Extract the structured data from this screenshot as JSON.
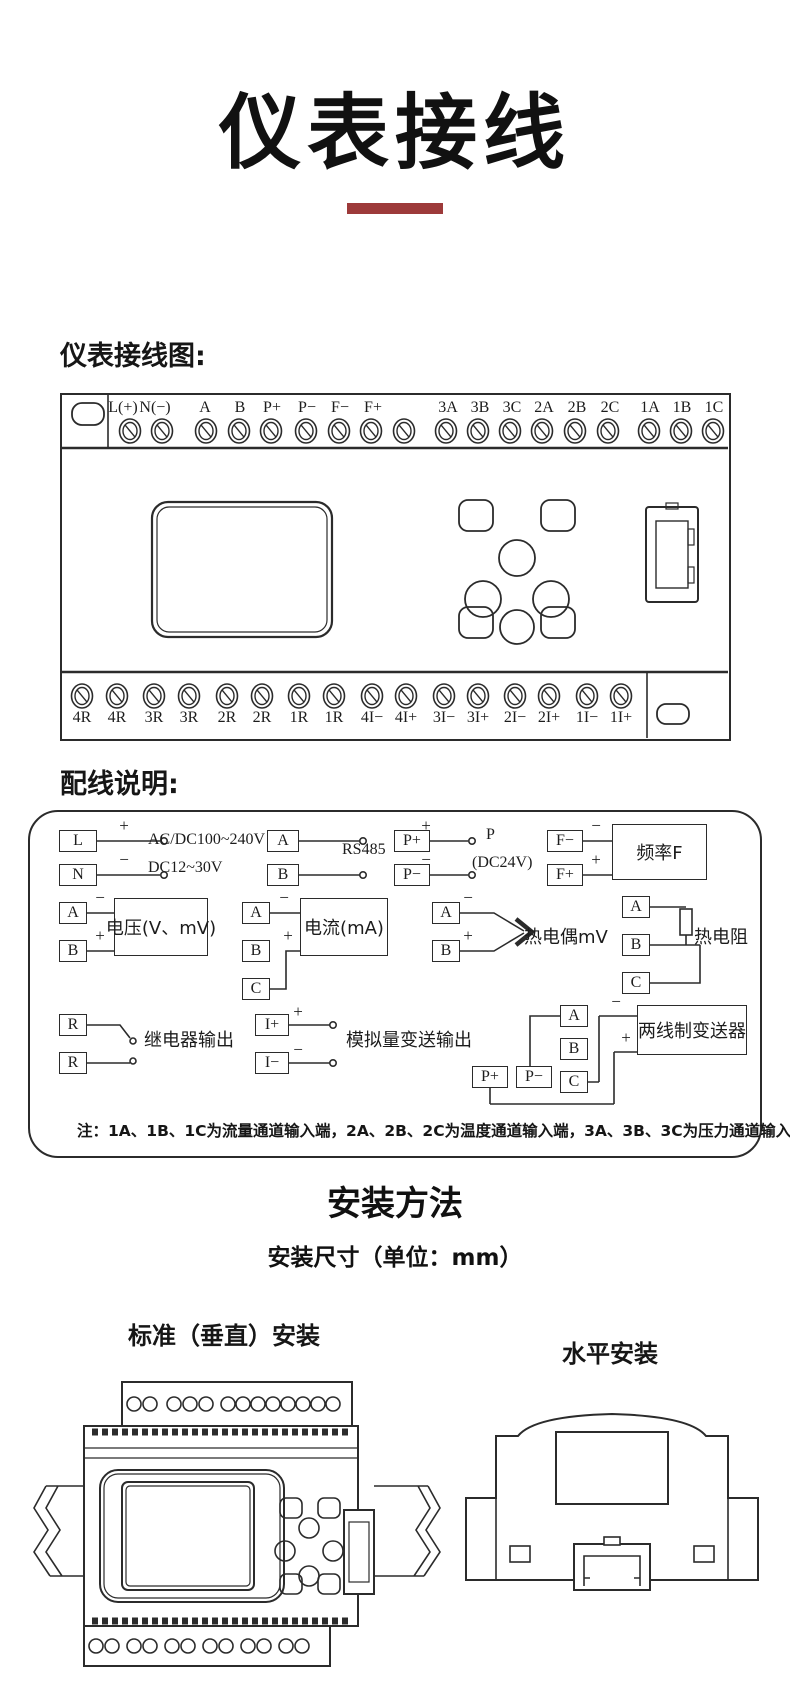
{
  "page": {
    "title": "仪表接线",
    "accent_color": "#9d3a3a"
  },
  "terminal_diagram": {
    "heading": "仪表接线图:",
    "top_terminals": [
      "L(+)",
      "N(−)",
      "A",
      "B",
      "P+",
      "P−",
      "F−",
      "F+",
      "3A",
      "3B",
      "3C",
      "2A",
      "2B",
      "2C",
      "1A",
      "1B",
      "1C"
    ],
    "bottom_terminals": [
      "4R",
      "4R",
      "3R",
      "3R",
      "2R",
      "2R",
      "1R",
      "1R",
      "4I−",
      "4I+",
      "3I−",
      "3I+",
      "2I−",
      "2I+",
      "1I−",
      "1I+"
    ]
  },
  "wiring_panel": {
    "heading": "配线说明:",
    "groups": [
      {
        "id": "power",
        "terminals": [
          "L",
          "N"
        ],
        "signs": [
          "+",
          "−"
        ],
        "labels": [
          "AC/DC100~240V",
          "DC12~30V"
        ]
      },
      {
        "id": "rs485",
        "terminals": [
          "A",
          "B"
        ],
        "labels": [
          "RS485"
        ]
      },
      {
        "id": "aux-power",
        "terminals": [
          "P+",
          "P−"
        ],
        "signs": [
          "+",
          "−"
        ],
        "labels": [
          "P",
          "(DC24V)"
        ]
      },
      {
        "id": "frequency",
        "terminals": [
          "F−",
          "F+"
        ],
        "signs": [
          "−",
          "+"
        ],
        "box_label": "频率F"
      },
      {
        "id": "voltage",
        "terminals": [
          "A",
          "B"
        ],
        "signs": [
          "−",
          "+"
        ],
        "box_label": "电压(V、mV)"
      },
      {
        "id": "current",
        "terminals": [
          "A",
          "B",
          "C"
        ],
        "signs": [
          "−",
          "+"
        ],
        "box_label": "电流(mA)"
      },
      {
        "id": "thermocouple",
        "terminals": [
          "A",
          "B"
        ],
        "signs": [
          "−",
          "+"
        ],
        "labels": [
          "热电偶mV"
        ]
      },
      {
        "id": "rtd",
        "terminals": [
          "A",
          "B",
          "C"
        ],
        "labels": [
          "热电阻"
        ]
      },
      {
        "id": "relay",
        "terminals": [
          "R",
          "R"
        ],
        "labels": [
          "继电器输出"
        ]
      },
      {
        "id": "analog-output",
        "terminals": [
          "I+",
          "I−"
        ],
        "signs": [
          "+",
          "−"
        ],
        "labels": [
          "模拟量变送输出"
        ]
      },
      {
        "id": "two-wire-transmitter",
        "terminals": [
          "A",
          "B",
          "C",
          "P+",
          "P−"
        ],
        "signs": [
          "−",
          "+"
        ],
        "box_label": "两线制变送器"
      }
    ],
    "note": "注：1A、1B、1C为流量通道输入端，2A、2B、2C为温度通道输入端，3A、3B、3C为压力通道输入端"
  },
  "installation": {
    "title": "安装方法",
    "subtitle": "安装尺寸（单位：mm）",
    "vertical_label": "标准（垂直）安装",
    "horizontal_label": "水平安装"
  }
}
